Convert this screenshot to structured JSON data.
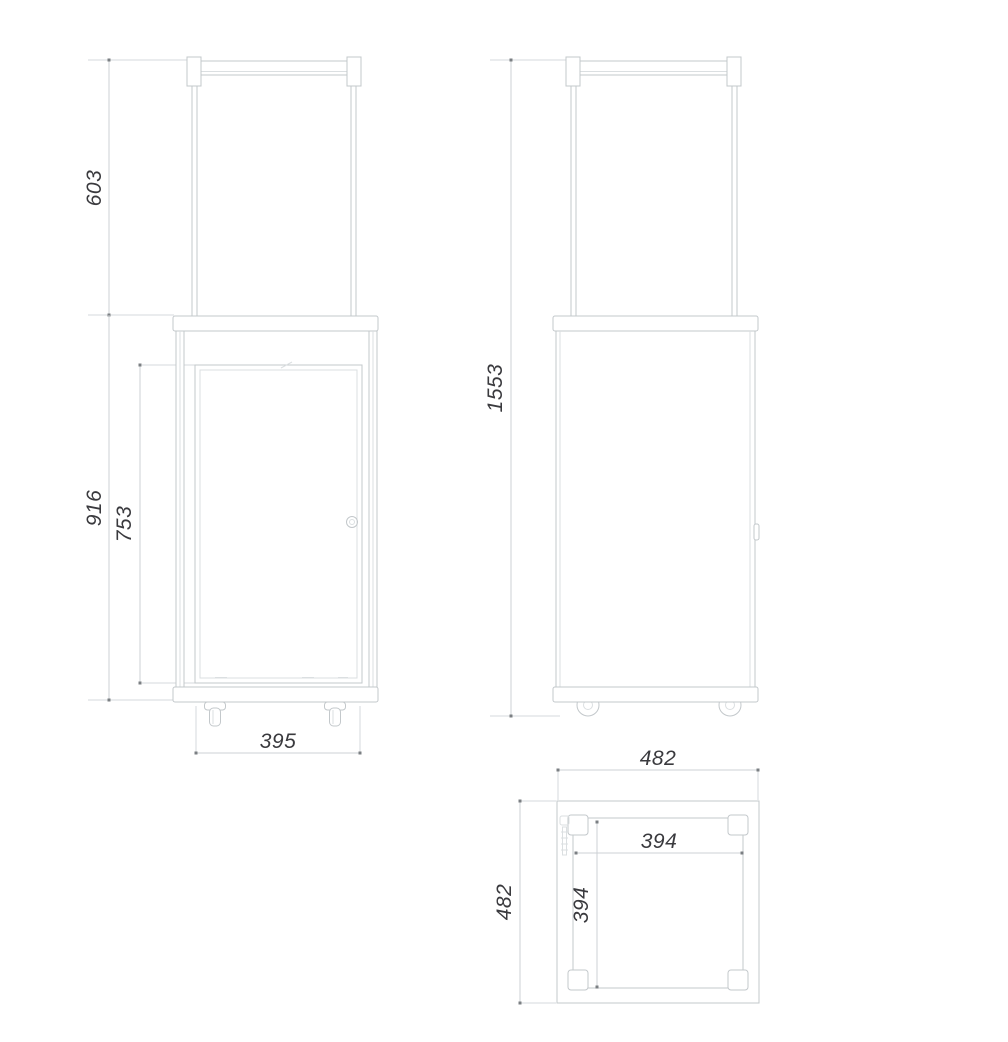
{
  "drawing": {
    "colors": {
      "background": "#ffffff",
      "object_line": "#c3c8cb",
      "dimension_line": "#ccd1d4",
      "dimension_text": "#3a3a3e"
    },
    "front_view": {
      "top_section_height": "603",
      "body_height": "916",
      "door_height": "753",
      "body_width": "395"
    },
    "side_view": {
      "total_height": "1553"
    },
    "top_view": {
      "outer_width": "482",
      "outer_depth": "482",
      "inner_width": "394",
      "inner_depth": "394"
    }
  }
}
